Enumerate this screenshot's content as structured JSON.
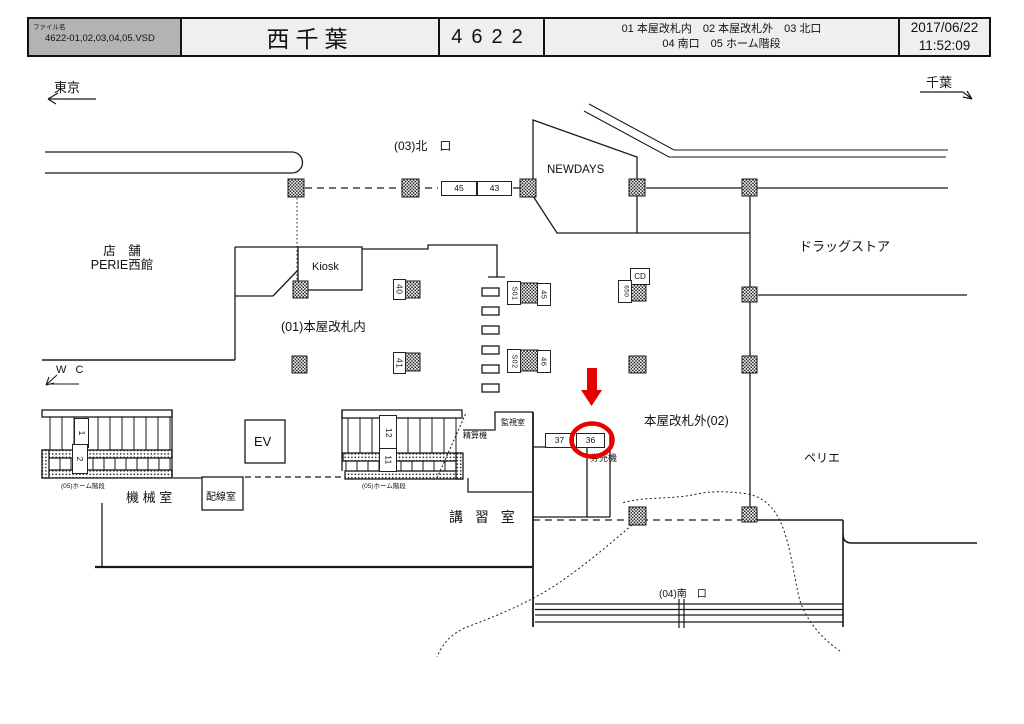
{
  "header": {
    "file_label": "ファイル名",
    "file_name": "4622-01,02,03,04,05.VSD",
    "station_name": "西千葉",
    "station_code": "4622",
    "index_line1": "01 本屋改札内　02 本屋改札外　03 北口",
    "index_line2": "04 南口　05 ホーム階段",
    "date": "2017/06/22",
    "time": "11:52:09"
  },
  "directions": {
    "left": "東京",
    "right": "千葉"
  },
  "areas": {
    "north_gate": "(03)北　口",
    "newdays": "NEWDAYS",
    "drugstore": "ドラッグストア",
    "shop_line1": "店　舗",
    "shop_line2": "PERIE西館",
    "kiosk": "Kiosk",
    "inside_gate": "(01)本屋改札内",
    "outside_gate": "本屋改札外(02)",
    "wc": "W C",
    "machine_room": "機 械 室",
    "wiring_room": "配線室",
    "ev": "EV",
    "monitor_room": "監視室",
    "fare_adjust": "精算機",
    "ticket_machine": "券売機",
    "lecture_room": "講 習 室",
    "perie": "ペリエ",
    "south_gate": "(04)南　口",
    "platform_stairs_left": "(05)ホーム階段",
    "platform_stairs_mid": "(05)ホーム階段"
  },
  "signs": {
    "s45": "45",
    "s43": "43",
    "s40": "40",
    "s41": "41",
    "s01": "S01",
    "s45b": "45",
    "s02": "S02",
    "s46": "46",
    "cd": "CD",
    "s650": "650",
    "s37": "37",
    "s36": "36",
    "stair1": "1",
    "stair2": "2",
    "stair11": "11",
    "stair12": "12"
  },
  "highlight": {
    "target": "36",
    "color": "#e60000"
  }
}
